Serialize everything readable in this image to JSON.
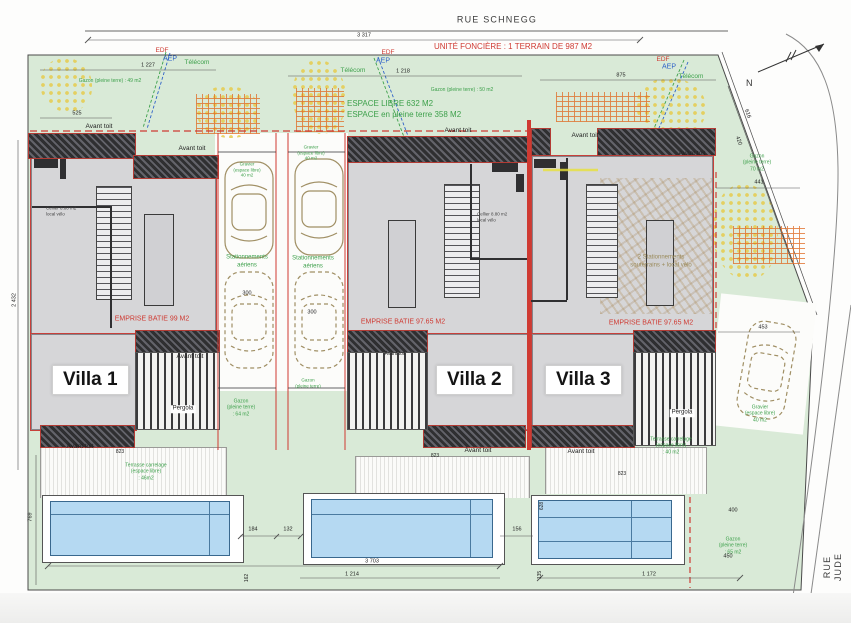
{
  "streets": {
    "top": "RUE SCHNEGG",
    "right": "RUE JUDE"
  },
  "parcel": {
    "unite_fonciere": "UNITÉ FONCIÈRE : 1 TERRAIN DE 987 M2",
    "espace_libre": "ESPACE LIBRE 632 M2",
    "espace_pleine_terre": "ESPACE en pleine terre 358 M2",
    "north_letter": "N"
  },
  "villas": [
    {
      "name": "Villa 1",
      "emprise": "EMPRISE BATIE 99 M2",
      "cellier": "Cellier 8.80 m2\nlocal vélo"
    },
    {
      "name": "Villa 2",
      "emprise": "EMPRISE BATIE 97.65 M2",
      "cellier": "Cellier 8.80 m2\nlocal vélo"
    },
    {
      "name": "Villa 3",
      "emprise": "EMPRISE BATIE 97.65 M2",
      "parking": "2 Stationnements\nsouterrains + local vélo"
    }
  ],
  "labels": {
    "avant_toit": "Avant toit",
    "pergola": "Pergola",
    "stationnements": "Stationnements\naériens",
    "telecom": "Télécom",
    "edf": "EDF",
    "aep": "AEP"
  },
  "areas": {
    "gazon_49": "Gazon (pleine terre) : 49 m2",
    "gazon_50": "Gazon (pleine terre) : 50 m2",
    "gazon_64": "Gazon\n(pleine terre)\n: 64 m2",
    "gazon_65": "Gazon\n(pleine terre)\n: 65 m2",
    "gazon_70": "Gazon\n(pleine terre)\n70 m2",
    "gazon_plain": "Gazon\n(pleine terre)",
    "gravier_40": "Gravier\n(espace libre)\n40 m2",
    "terrasse_46": "Terrasse carrelage\n(espace libre)\n: 46m2",
    "terrasse_40": "Terrasse carrelage\n(espace libre)\n: 40 m2"
  },
  "dims": {
    "d3317": "3 317",
    "d1227": "1 227",
    "d1218": "1 218",
    "d875": "875",
    "d525": "525",
    "d616": "616",
    "d420": "420",
    "d441": "441",
    "d2432": "2 432",
    "d769": "769",
    "d300": "300",
    "d823": "823",
    "d184": "184",
    "d132": "132",
    "d156": "156",
    "d162": "162",
    "d135": "135",
    "d3703": "3 703",
    "d1214": "1 214",
    "d1172": "1 172",
    "d400": "400",
    "d450": "450",
    "d453": "453",
    "d628": "628"
  },
  "colors": {
    "site_green": "#d9ead7",
    "pool_blue": "#b5d9f2",
    "red_line": "#cf3a32",
    "green_text": "#3da04b",
    "orange": "#e07830"
  }
}
